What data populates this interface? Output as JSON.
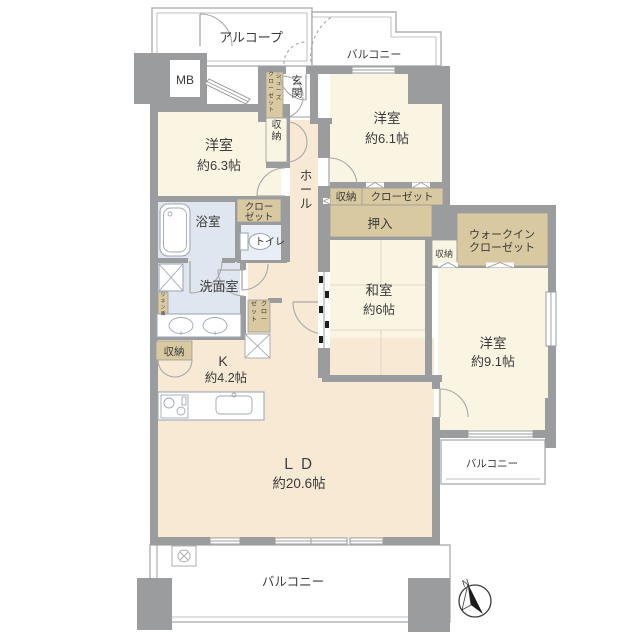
{
  "palette": {
    "wall": "#9b9c9e",
    "room_cream": "#faf5e3",
    "room_warm": "#f8e9d4",
    "wet": "#dfe6f0",
    "wet2": "#e9edf5",
    "closet_tan": "#d9c9a1",
    "tatami": "#ddd8c2",
    "outline": "#aeb0b2",
    "text": "#3a3a3a"
  },
  "plan": {
    "alcove": "アルコープ",
    "balcony_top": "バルコニー",
    "balcony_right": "バルコニー",
    "balcony_bottom": "バルコニー",
    "meter_box": "MB",
    "entrance": "玄関",
    "shoes_closet_l1": "シューズ",
    "shoes_closet_l2": "クローゼット",
    "entrance_storage": "収納",
    "bedroom63_name": "洋室",
    "bedroom63_size": "約6.3帖",
    "closet63_l1": "クロー",
    "closet63_l2": "ゼット",
    "bath": "浴室",
    "toilet": "トイレ",
    "washroom": "洗面室",
    "linen": "リネン庫",
    "hall": "ホール",
    "hall_closet_l1": "クロー",
    "hall_closet_l2": "ゼット",
    "storage_strip": "収納",
    "closet61": "クローゼット",
    "oshiire": "押入",
    "bedroom61_name": "洋室",
    "bedroom61_size": "約6.1帖",
    "washitsu_name": "和室",
    "washitsu_size": "約6帖",
    "storage_wic": "収納",
    "wic_l1": "ウォークイン",
    "wic_l2": "クローゼット",
    "bedroom91_name": "洋室",
    "bedroom91_size": "約9.1帖",
    "kitchen_storage": "収納",
    "kitchen_name": "K",
    "kitchen_size": "約4.2帖",
    "ld_name": "ＬＤ",
    "ld_size": "約20.6帖",
    "compass_n": "N"
  }
}
